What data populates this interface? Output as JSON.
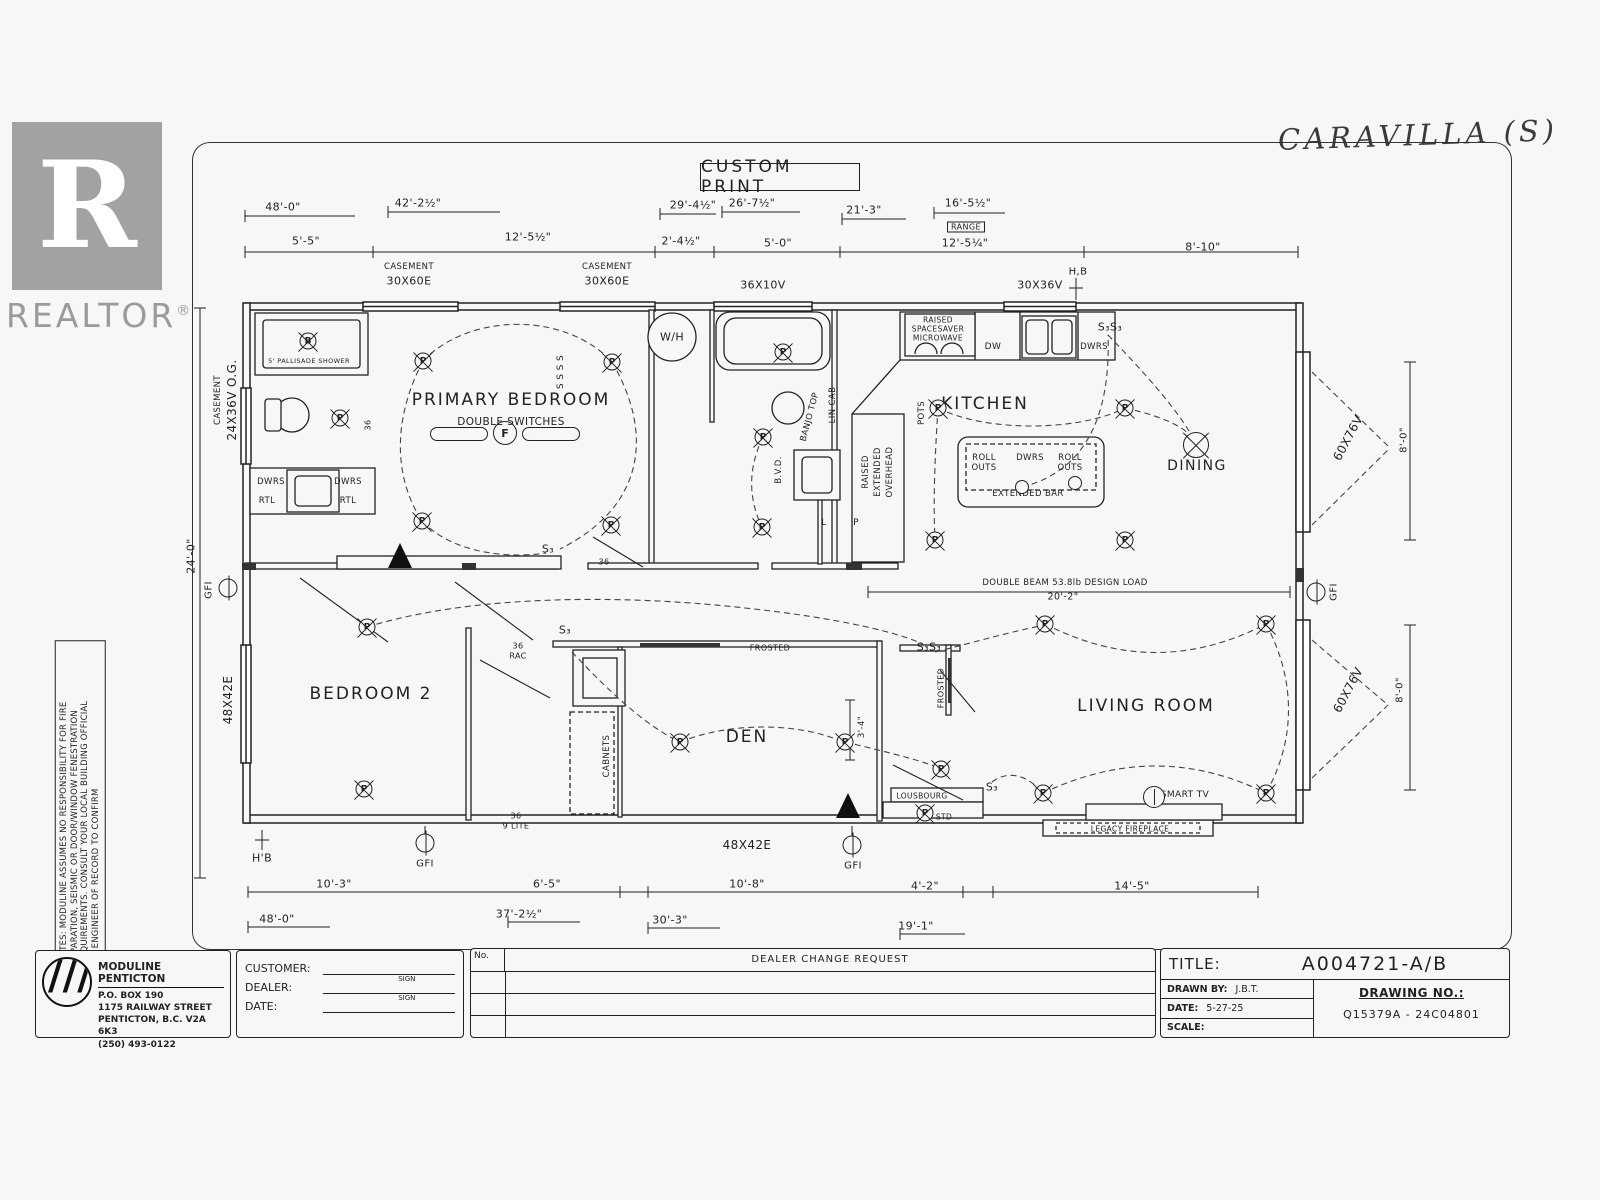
{
  "header": {
    "custom_print": "CUSTOM PRINT",
    "handwritten_model": "CARAVILLA (S)"
  },
  "realtor": {
    "letter": "R",
    "brand": "REALTOR",
    "reg": "®"
  },
  "notes": {
    "line1": "NOTES: MODULINE ASSUMES NO RESPONSIBILITY FOR FIRE",
    "line2": "SEPARATION, SEISMIC OR DOOR/WINDOW FENESTRATION",
    "line3": "REQUIREMENTS. CONSULT YOUR LOCAL BUILDING OFFICIAL",
    "line4": "OR ENGINEER OF RECORD TO CONFIRM"
  },
  "title_block": {
    "company": "MODULINE PENTICTON",
    "address1": "P.O. BOX 190",
    "address2": "1175 RAILWAY STREET",
    "address3": "PENTICTON, B.C. V2A 6K3",
    "phone": "(250) 493-0122",
    "customer_label": "CUSTOMER:",
    "dealer_label": "DEALER:",
    "date_label": "DATE:",
    "sign_label": "SIGN",
    "no_label": "No.",
    "change_header": "DEALER CHANGE REQUEST",
    "title_label": "TITLE:",
    "title_value": "A004721-A/B",
    "drawn_by_label": "DRAWN BY:",
    "drawn_by_value": "J.B.T.",
    "date2_label": "DATE:",
    "date_value": "5-27-25",
    "scale_label": "SCALE:",
    "drawing_no_label": "DRAWING NO.:",
    "drawing_no_value": "Q15379A - 24C04801"
  },
  "plan": {
    "accent_color": "#222222",
    "marks": [
      {
        "n": "dim-48-0-top",
        "t": "48'-0\"",
        "x": 283,
        "y": 207
      },
      {
        "n": "dim-42-2half",
        "t": "42'-2½\"",
        "x": 418,
        "y": 203
      },
      {
        "n": "dim-29-4half",
        "t": "29'-4½\"",
        "x": 693,
        "y": 205
      },
      {
        "n": "dim-26-7half",
        "t": "26'-7½\"",
        "x": 752,
        "y": 203
      },
      {
        "n": "dim-21-3",
        "t": "21'-3\"",
        "x": 864,
        "y": 210
      },
      {
        "n": "dim-16-5half",
        "t": "16'-5½\"",
        "x": 968,
        "y": 203
      },
      {
        "n": "range-label",
        "t": "RANGE",
        "x": 966,
        "y": 227,
        "s": 8,
        "c": "lbl boxed"
      },
      {
        "n": "dim-5-5",
        "t": "5'-5\"",
        "x": 306,
        "y": 241
      },
      {
        "n": "dim-12-5half",
        "t": "12'-5½\"",
        "x": 528,
        "y": 237
      },
      {
        "n": "dim-2-4half",
        "t": "2'-4½\"",
        "x": 681,
        "y": 241
      },
      {
        "n": "dim-5-0",
        "t": "5'-0\"",
        "x": 778,
        "y": 243
      },
      {
        "n": "dim-12-5quarter",
        "t": "12'-5¼\"",
        "x": 965,
        "y": 243
      },
      {
        "n": "dim-8-10",
        "t": "8'-10\"",
        "x": 1203,
        "y": 247
      },
      {
        "n": "window-casement-1a",
        "t": "CASEMENT",
        "x": 409,
        "y": 267,
        "s": 8.5
      },
      {
        "n": "window-30x60e-1",
        "t": "30X60E",
        "x": 409,
        "y": 281
      },
      {
        "n": "window-casement-2a",
        "t": "CASEMENT",
        "x": 607,
        "y": 267,
        "s": 8.5
      },
      {
        "n": "window-30x60e-2",
        "t": "30X60E",
        "x": 607,
        "y": 281
      },
      {
        "n": "window-36x10v",
        "t": "36X10V",
        "x": 763,
        "y": 285
      },
      {
        "n": "window-30x36v",
        "t": "30X36V",
        "x": 1040,
        "y": 285
      },
      {
        "n": "hose-bib-top",
        "t": "H,B",
        "x": 1078,
        "y": 272,
        "s": 10
      },
      {
        "n": "window-casement-left-a",
        "t": "CASEMENT",
        "x": 218,
        "y": 400,
        "r": -90,
        "s": 8.5
      },
      {
        "n": "window-24x36v-og",
        "t": "24X36V O.G.",
        "x": 232,
        "y": 400,
        "r": -90,
        "s": 12
      },
      {
        "n": "dim-24-0-left",
        "t": "24'-0\"",
        "x": 191,
        "y": 556,
        "r": -90
      },
      {
        "n": "gfi-left-label",
        "t": "GFI",
        "x": 209,
        "y": 590,
        "r": -90,
        "s": 10
      },
      {
        "n": "window-48x42e-left",
        "t": "48X42E",
        "x": 228,
        "y": 700,
        "r": -90,
        "s": 12
      },
      {
        "n": "window-60x76v-upper",
        "t": "60X76V",
        "x": 1348,
        "y": 438,
        "r": -62,
        "s": 12
      },
      {
        "n": "dim-8-0-upper",
        "t": "8'-0\"",
        "x": 1404,
        "y": 440,
        "r": -90,
        "s": 10
      },
      {
        "n": "gfi-right-label",
        "t": "GFI",
        "x": 1334,
        "y": 592,
        "r": -90,
        "s": 10
      },
      {
        "n": "window-60x76v-lower",
        "t": "60X76V",
        "x": 1348,
        "y": 690,
        "r": -62,
        "s": 12
      },
      {
        "n": "dim-8-0-lower",
        "t": "8'-0\"",
        "x": 1400,
        "y": 690,
        "r": -90,
        "s": 10
      },
      {
        "n": "room-primary-bedroom",
        "t": "PRIMARY BEDROOM",
        "x": 511,
        "y": 400,
        "c": "mark big"
      },
      {
        "n": "note-double-switches",
        "t": "DOUBLE SWITCHES",
        "x": 511,
        "y": 422,
        "s": 10.5
      },
      {
        "n": "room-kitchen",
        "t": "KITCHEN",
        "x": 985,
        "y": 404,
        "c": "mark big"
      },
      {
        "n": "room-dining",
        "t": "DINING",
        "x": 1197,
        "y": 466,
        "c": "mark med"
      },
      {
        "n": "room-bedroom-2",
        "t": "BEDROOM 2",
        "x": 371,
        "y": 694,
        "c": "mark big"
      },
      {
        "n": "room-den",
        "t": "DEN",
        "x": 747,
        "y": 737,
        "c": "mark big"
      },
      {
        "n": "room-living-room",
        "t": "LIVING ROOM",
        "x": 1146,
        "y": 706,
        "c": "mark big"
      },
      {
        "n": "fixture-pallisade-shower",
        "t": "5' PALLISADE SHOWER",
        "x": 309,
        "y": 361,
        "s": 6.5
      },
      {
        "n": "fixture-water-heater",
        "t": "W/H",
        "x": 672,
        "y": 337,
        "s": 11
      },
      {
        "n": "cab-dwrs-left",
        "t": "DWRS",
        "x": 271,
        "y": 482,
        "s": 8.5
      },
      {
        "n": "cab-dwrs-right",
        "t": "DWRS",
        "x": 348,
        "y": 482,
        "s": 8.5
      },
      {
        "n": "cab-rtl-left",
        "t": "RTL",
        "x": 267,
        "y": 501,
        "s": 8.5
      },
      {
        "n": "cab-rtl-right",
        "t": "RTL",
        "x": 348,
        "y": 501,
        "s": 8.5
      },
      {
        "n": "mw-raised",
        "t": "RAISED",
        "x": 938,
        "y": 320,
        "s": 7.5
      },
      {
        "n": "mw-spacesaver",
        "t": "SPACESAVER",
        "x": 938,
        "y": 329,
        "s": 7.5
      },
      {
        "n": "mw-microwave",
        "t": "MICROWAVE",
        "x": 938,
        "y": 338,
        "s": 7.5
      },
      {
        "n": "appl-dw",
        "t": "DW",
        "x": 993,
        "y": 347,
        "s": 9
      },
      {
        "n": "cab-dwrs-kitchen",
        "t": "DWRS",
        "x": 1094,
        "y": 347,
        "s": 8.5
      },
      {
        "n": "island-roll-1",
        "t": "ROLL",
        "x": 984,
        "y": 458,
        "s": 8.5
      },
      {
        "n": "island-outs-1",
        "t": "OUTS",
        "x": 984,
        "y": 468,
        "s": 8.5
      },
      {
        "n": "island-dwrs",
        "t": "DWRS",
        "x": 1030,
        "y": 458,
        "s": 8.5
      },
      {
        "n": "island-roll-2",
        "t": "ROLL",
        "x": 1070,
        "y": 458,
        "s": 8.5
      },
      {
        "n": "island-outs-2",
        "t": "OUTS",
        "x": 1070,
        "y": 468,
        "s": 8.5
      },
      {
        "n": "island-extended-bar",
        "t": "EXTENDED BAR",
        "x": 1028,
        "y": 494,
        "s": 8.5
      },
      {
        "n": "cab-pots",
        "t": "POTS",
        "x": 922,
        "y": 413,
        "r": -90,
        "s": 8.5
      },
      {
        "n": "cab-raised",
        "t": "RAISED",
        "x": 866,
        "y": 472,
        "r": -90,
        "s": 8.5
      },
      {
        "n": "cab-extended",
        "t": "EXTENDED",
        "x": 878,
        "y": 472,
        "r": -90,
        "s": 8.5
      },
      {
        "n": "cab-overhead",
        "t": "OVERHEAD",
        "x": 890,
        "y": 472,
        "r": -90,
        "s": 8.5
      },
      {
        "n": "cab-banjo-top",
        "t": "BANJO TOP",
        "x": 810,
        "y": 417,
        "r": -75,
        "s": 8.5
      },
      {
        "n": "cab-lin-cab",
        "t": "LIN CAB",
        "x": 833,
        "y": 405,
        "r": -90,
        "s": 8.5
      },
      {
        "n": "fixture-bvd",
        "t": "B.V.D.",
        "x": 779,
        "y": 470,
        "r": -90,
        "s": 8.5
      },
      {
        "n": "closet-l",
        "t": "L",
        "x": 824,
        "y": 523,
        "s": 9
      },
      {
        "n": "closet-p",
        "t": "P",
        "x": 856,
        "y": 523,
        "s": 9
      },
      {
        "n": "switch-s3s3-kitchen",
        "t": "S₃S₃",
        "x": 1110,
        "y": 327,
        "s": 11
      },
      {
        "n": "beam-note",
        "t": "DOUBLE BEAM 53.8lb DESIGN LOAD",
        "x": 1065,
        "y": 583,
        "s": 8.5
      },
      {
        "n": "dim-20-2",
        "t": "20'-2\"",
        "x": 1063,
        "y": 597,
        "s": 9.5
      },
      {
        "n": "switch-s3-hall",
        "t": "S₃",
        "x": 565,
        "y": 630,
        "s": 11
      },
      {
        "n": "door-36-rac-a",
        "t": "36",
        "x": 518,
        "y": 646,
        "s": 8
      },
      {
        "n": "door-36-rac-b",
        "t": "RAC",
        "x": 518,
        "y": 656,
        "s": 8
      },
      {
        "n": "door-36-9lite-a",
        "t": "36",
        "x": 516,
        "y": 816,
        "s": 8
      },
      {
        "n": "door-36-9lite-b",
        "t": "9 LITE",
        "x": 516,
        "y": 826,
        "s": 8
      },
      {
        "n": "window-frosted-den",
        "t": "FROSTED",
        "x": 770,
        "y": 648,
        "s": 8
      },
      {
        "n": "window-frosted-living",
        "t": "FROSTED",
        "x": 941,
        "y": 688,
        "r": -90,
        "s": 8
      },
      {
        "n": "cab-cabinets",
        "t": "CABNETS",
        "x": 607,
        "y": 756,
        "r": -90,
        "s": 8.5
      },
      {
        "n": "switch-s3s3-living",
        "t": "S₃S₃",
        "x": 929,
        "y": 647,
        "s": 11
      },
      {
        "n": "switch-s3-living",
        "t": "S₃",
        "x": 992,
        "y": 787,
        "s": 11
      },
      {
        "n": "fixture-lousbourg",
        "t": "LOUSBOURG",
        "x": 922,
        "y": 796,
        "s": 7.5
      },
      {
        "n": "fixture-std",
        "t": "STD",
        "x": 944,
        "y": 817,
        "s": 7.5
      },
      {
        "n": "fixture-smart-tv",
        "t": "SMART TV",
        "x": 1185,
        "y": 795,
        "s": 9
      },
      {
        "n": "fixture-legacy-fireplace",
        "t": "LEGACY FIREPLACE",
        "x": 1130,
        "y": 829,
        "s": 7.5
      },
      {
        "n": "dim-3-4",
        "t": "3'-4\"",
        "x": 862,
        "y": 727,
        "r": -90,
        "s": 8.5
      },
      {
        "n": "door-36-bedroom",
        "t": "36",
        "x": 368,
        "y": 425,
        "r": -90,
        "s": 8
      },
      {
        "n": "door-36-hall",
        "t": "36",
        "x": 604,
        "y": 562,
        "s": 8
      },
      {
        "n": "switch-s3-bedroom",
        "t": "S₃",
        "x": 548,
        "y": 549,
        "s": 11
      },
      {
        "n": "switch-ssss",
        "t": "S S S S",
        "x": 561,
        "y": 372,
        "r": -90,
        "s": 9
      },
      {
        "n": "hose-bib-bottom",
        "t": "H'B",
        "x": 262,
        "y": 858,
        "s": 11
      },
      {
        "n": "gfi-bottom-left-label",
        "t": "GFI",
        "x": 425,
        "y": 864,
        "s": 10
      },
      {
        "n": "window-48x42e-bottom",
        "t": "48X42E",
        "x": 747,
        "y": 845,
        "s": 12
      },
      {
        "n": "gfi-bottom-right-label",
        "t": "GFI",
        "x": 853,
        "y": 866,
        "s": 10
      },
      {
        "n": "dim-10-3",
        "t": "10'-3\"",
        "x": 334,
        "y": 884
      },
      {
        "n": "dim-6-5",
        "t": "6'-5\"",
        "x": 547,
        "y": 884
      },
      {
        "n": "dim-10-8",
        "t": "10'-8\"",
        "x": 747,
        "y": 884
      },
      {
        "n": "dim-4-2",
        "t": "4'-2\"",
        "x": 925,
        "y": 886
      },
      {
        "n": "dim-14-5",
        "t": "14'-5\"",
        "x": 1132,
        "y": 886
      },
      {
        "n": "dim-48-0-bottom",
        "t": "48'-0\"",
        "x": 277,
        "y": 919
      },
      {
        "n": "dim-37-2half",
        "t": "37'-2½\"",
        "x": 519,
        "y": 914
      },
      {
        "n": "dim-30-3",
        "t": "30'-3\"",
        "x": 670,
        "y": 920
      },
      {
        "n": "dim-19-1",
        "t": "19'-1\"",
        "x": 916,
        "y": 926
      },
      {
        "n": "light-pb-1",
        "t": "P",
        "x": 423,
        "y": 361,
        "c": "mark sym-light"
      },
      {
        "n": "light-pb-2",
        "t": "P",
        "x": 612,
        "y": 362,
        "c": "mark sym-light"
      },
      {
        "n": "light-pb-3",
        "t": "P",
        "x": 422,
        "y": 521,
        "c": "mark sym-light"
      },
      {
        "n": "light-pb-4",
        "t": "P",
        "x": 611,
        "y": 525,
        "c": "mark sym-light"
      },
      {
        "n": "light-bath1",
        "t": "P",
        "x": 340,
        "y": 418,
        "c": "mark sym-light"
      },
      {
        "n": "light-bath2-tub",
        "t": "P",
        "x": 783,
        "y": 352,
        "c": "mark sym-light"
      },
      {
        "n": "light-hall-1",
        "t": "P",
        "x": 763,
        "y": 437,
        "c": "mark sym-light"
      },
      {
        "n": "light-hall-2",
        "t": "P",
        "x": 762,
        "y": 527,
        "c": "mark sym-light"
      },
      {
        "n": "light-kitchen-1",
        "t": "P",
        "x": 938,
        "y": 408,
        "c": "mark sym-light"
      },
      {
        "n": "light-kitchen-2",
        "t": "P",
        "x": 1125,
        "y": 408,
        "c": "mark sym-light"
      },
      {
        "n": "light-kitchen-3",
        "t": "P",
        "x": 935,
        "y": 540,
        "c": "mark sym-light"
      },
      {
        "n": "light-kitchen-4",
        "t": "P",
        "x": 1125,
        "y": 540,
        "c": "mark sym-light"
      },
      {
        "n": "light-bed2-1",
        "t": "P",
        "x": 367,
        "y": 627,
        "c": "mark sym-light"
      },
      {
        "n": "light-bed2-2",
        "t": "P",
        "x": 364,
        "y": 789,
        "c": "mark sym-light"
      },
      {
        "n": "light-den-1",
        "t": "P",
        "x": 680,
        "y": 742,
        "c": "mark sym-light"
      },
      {
        "n": "light-den-2",
        "t": "P",
        "x": 845,
        "y": 742,
        "c": "mark sym-light"
      },
      {
        "n": "light-living-1",
        "t": "P",
        "x": 1045,
        "y": 624,
        "c": "mark sym-light"
      },
      {
        "n": "light-living-2",
        "t": "P",
        "x": 1266,
        "y": 624,
        "c": "mark sym-light"
      },
      {
        "n": "light-living-3",
        "t": "P",
        "x": 1266,
        "y": 793,
        "c": "mark sym-light"
      },
      {
        "n": "light-living-4",
        "t": "P",
        "x": 1043,
        "y": 793,
        "c": "mark sym-light"
      },
      {
        "n": "light-entry",
        "t": "P",
        "x": 941,
        "y": 769,
        "c": "mark sym-light"
      },
      {
        "n": "light-std",
        "t": "P",
        "x": 925,
        "y": 813,
        "c": "mark sym-light"
      },
      {
        "n": "light-shower-b",
        "t": "B",
        "x": 308,
        "y": 341,
        "c": "mark sym-b"
      },
      {
        "n": "light-rollout-1",
        "x": 1022,
        "y": 487,
        "c": "mark sym-small"
      },
      {
        "n": "light-rollout-2",
        "x": 1075,
        "y": 483,
        "c": "mark sym-small"
      },
      {
        "n": "light-dining-chandelier",
        "x": 1196,
        "y": 445,
        "c": "mark sym-chand"
      },
      {
        "n": "gfi-left",
        "x": 228,
        "y": 588,
        "c": "mark sym-gfi"
      },
      {
        "n": "gfi-bottom-left",
        "x": 425,
        "y": 843,
        "c": "mark sym-gfi"
      },
      {
        "n": "gfi-bottom-right",
        "x": 852,
        "y": 845,
        "c": "mark sym-gfi"
      },
      {
        "n": "gfi-right",
        "x": 1316,
        "y": 592,
        "c": "mark sym-gfi"
      },
      {
        "n": "smart-tv-symbol",
        "x": 1154,
        "y": 797,
        "c": "mark sym-tv"
      }
    ]
  }
}
